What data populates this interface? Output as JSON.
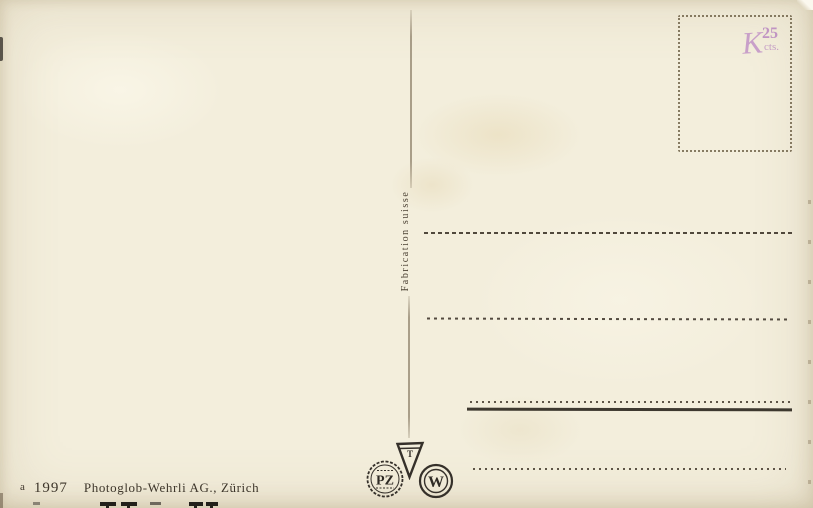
{
  "card": {
    "divider_label": "Fabrication suisse",
    "imprint": {
      "prefix": "a",
      "number": "1997",
      "publisher": "Photoglob-Wehrli AG., Zürich"
    }
  },
  "stamp_box": {
    "handstamp": {
      "letter": "K",
      "value": "25",
      "unit": "cts."
    }
  },
  "logos": {
    "triangle_letter": "T",
    "pz": "PZ",
    "w": "W"
  },
  "colors": {
    "background": "#f3eedc",
    "ink": "#3a3126",
    "handstamp_purple": "#c79fcb",
    "stamp_box_border": "#62553a"
  }
}
